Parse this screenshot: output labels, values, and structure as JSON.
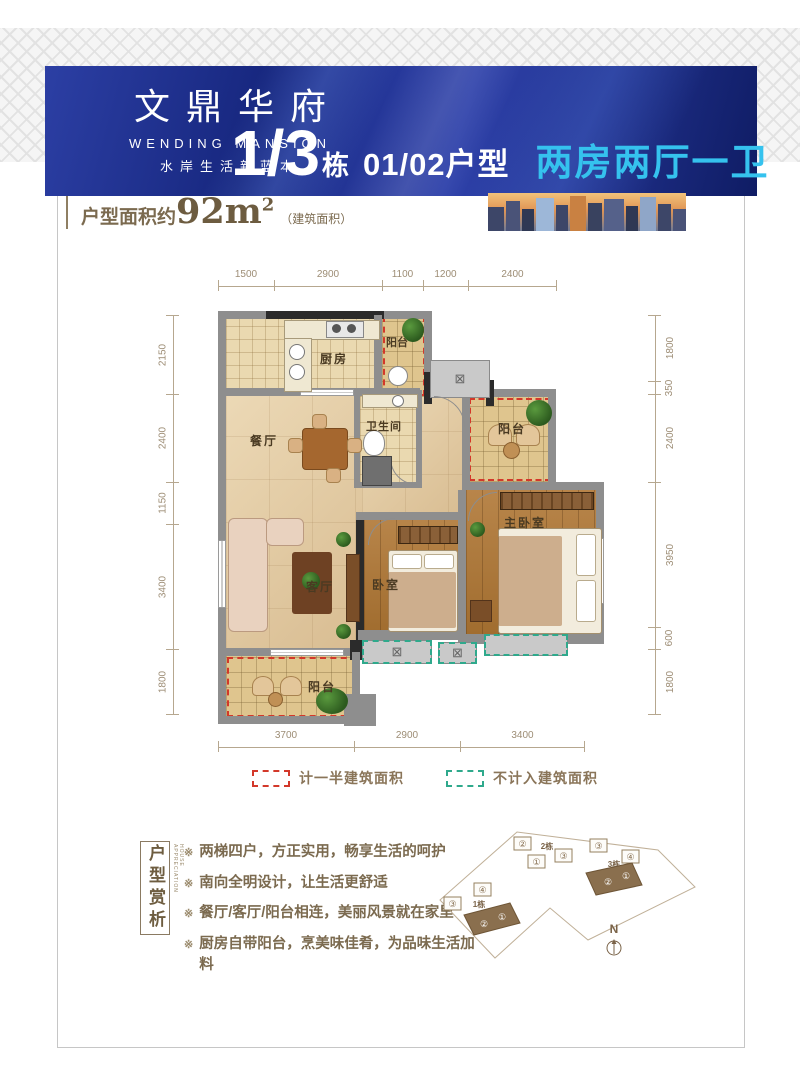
{
  "banner": {
    "logo_title": "文鼎华府",
    "logo_en": "WENDING MANSION",
    "logo_tagline": "水岸生活新蓝本",
    "block_number": "1/3",
    "block_unit": "栋",
    "unit_type": "01/02户型",
    "layout_type": "两房两厅一卫"
  },
  "area": {
    "prefix": "户型面积约",
    "value": "92m",
    "sup": "2",
    "note": "（建筑面积）"
  },
  "floorplan": {
    "dims_top": [
      "1500",
      "2900",
      "1100",
      "1200",
      "2400"
    ],
    "dims_left": [
      "2150",
      "2400",
      "1150",
      "3400",
      "1800"
    ],
    "dims_right": [
      "1800",
      "350",
      "2400",
      "3950",
      "600",
      "1800"
    ],
    "dims_bottom": [
      "3700",
      "2900",
      "3400"
    ],
    "rooms": {
      "kitchen": "厨房",
      "balcony_top": "阳台",
      "bathroom": "卫生间",
      "balcony_right": "阳台",
      "dining": "餐厅",
      "living": "客厅",
      "bedroom": "卧室",
      "master_bedroom": "主卧室",
      "balcony_bottom": "阳台"
    },
    "ac_symbol": "⊠"
  },
  "legend": {
    "half_area": "计一半建筑面积",
    "excluded": "不计入建筑面积"
  },
  "analysis": {
    "title": "户型赏析",
    "title_en": "HOUSE APPRECIATION",
    "marker": "※",
    "bullets": [
      "两梯四户，方正实用，畅享生活的呵护",
      "南向全明设计，让生活更舒适",
      "餐厅/客厅/阳台相连，美丽风景就在家里",
      "厨房自带阳台，烹美味佳肴，为品味生活加料"
    ]
  },
  "siteplan": {
    "compass": "N",
    "b2": {
      "label": "2栋",
      "u1": "②",
      "u2": "①",
      "u3": "③"
    },
    "b3": {
      "label": "3栋",
      "u1": "③",
      "u2": "④",
      "h1": "②",
      "h2": "①"
    },
    "b1": {
      "label": "1栋",
      "u1": "③",
      "u2": "④",
      "h1": "②",
      "h2": "①"
    }
  },
  "colors": {
    "banner_blue": "#1c2b8b",
    "accent_cyan": "#35c2ee",
    "brown_text": "#7b6a4f",
    "dash_red": "#d3382a",
    "dash_green": "#2fa98c"
  }
}
